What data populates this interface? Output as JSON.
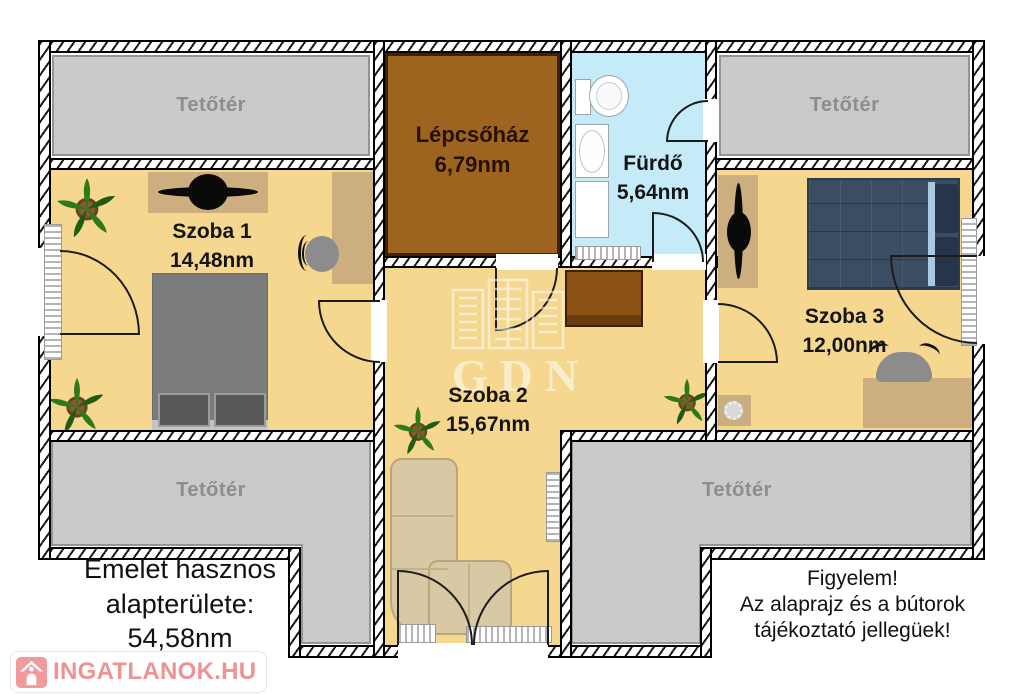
{
  "rooms": {
    "tetoter_top_left": {
      "name": "Tetőtér"
    },
    "tetoter_top_right": {
      "name": "Tetőtér"
    },
    "tetoter_bottom_left": {
      "name": "Tetőtér"
    },
    "tetoter_bottom_right": {
      "name": "Tetőtér"
    },
    "lepcsohaz": {
      "name": "Lépcsőház",
      "area": "6,79nm"
    },
    "furdo": {
      "name": "Fürdő",
      "area": "5,64nm"
    },
    "szoba1": {
      "name": "Szoba 1",
      "area": "14,48nm"
    },
    "szoba2": {
      "name": "Szoba 2",
      "area": "15,67nm"
    },
    "szoba3": {
      "name": "Szoba 3",
      "area": "12,00nm"
    }
  },
  "summary": {
    "line1": "Emelet hasznos",
    "line2": "alapterülete:",
    "line3": "54,58nm"
  },
  "disclaimer": {
    "line1": "Figyelem!",
    "line2": "Az alaprajz és a bútorok",
    "line3": "tájékoztató jellegüek!"
  },
  "watermark": {
    "text": "GDN"
  },
  "logo": {
    "text": "INGATLANOK.HU"
  },
  "icons": {
    "plant": "potted-plant-icon",
    "house": "house-icon",
    "toilet": "toilet-icon",
    "sink": "sink-icon",
    "buildings": "gdn-buildings-icon"
  },
  "colors": {
    "floor": "#f5d78f",
    "attic-fill": "#cacaca",
    "attic-border": "#949494",
    "attic-text": "#8d8d8d",
    "bath-fill": "#c6ebf8",
    "stair-fill": "#9d6420",
    "stair-border": "#3f2206",
    "stair-text": "#241102",
    "label-dark": "#151515",
    "tan": "#cdaf7f",
    "chest": "#8b5014",
    "couch": "#d9c8a4",
    "couch-border": "#b9a67e",
    "bed-gray": "#7b7b7b",
    "bed-navy": "#3b4d63",
    "pillow-navy": "#26354a",
    "pillow-accent": "#a9cbe2",
    "logo-pink": "#ee9293",
    "wall-dark": "#000000"
  }
}
